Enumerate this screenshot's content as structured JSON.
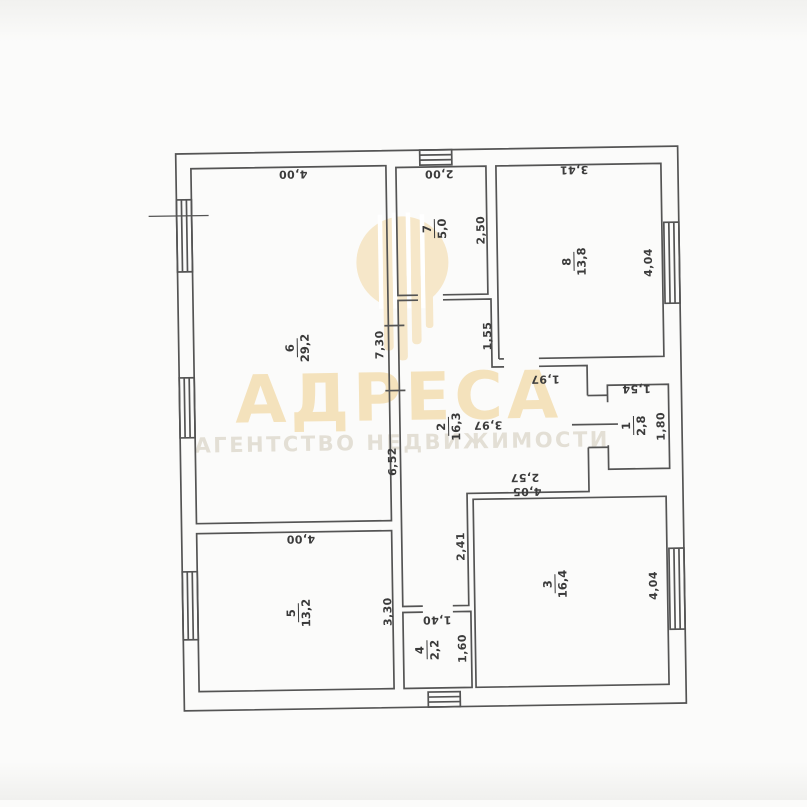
{
  "watermark": {
    "brand": "АДРЕСА",
    "tagline": "АГЕНТСТВО НЕДВИЖИМОСТИ",
    "brand_color": "#f4e2bc",
    "logo_color": "#f6e7c9",
    "tagline_color": "#e3dfd5"
  },
  "plan": {
    "line_color": "#545454",
    "rooms": [
      {
        "number": "6",
        "area": "29,2"
      },
      {
        "number": "7",
        "area": "5,0"
      },
      {
        "number": "8",
        "area": "13,8"
      },
      {
        "number": "2",
        "area": "16,3"
      },
      {
        "number": "1",
        "area": "2,8"
      },
      {
        "number": "3",
        "area": "16,4"
      },
      {
        "number": "5",
        "area": "13,2"
      },
      {
        "number": "4",
        "area": "2,2"
      }
    ],
    "dimensions": [
      {
        "value": "4,00"
      },
      {
        "value": "2,00"
      },
      {
        "value": "3,41"
      },
      {
        "value": "2,50"
      },
      {
        "value": "7,30"
      },
      {
        "value": "1,55"
      },
      {
        "value": "4,04"
      },
      {
        "value": "1,97"
      },
      {
        "value": "3,97"
      },
      {
        "value": "6,52"
      },
      {
        "value": "1,54"
      },
      {
        "value": "1,80"
      },
      {
        "value": "2,57"
      },
      {
        "value": "4,05"
      },
      {
        "value": "2,41"
      },
      {
        "value": "4,04"
      },
      {
        "value": "4,00"
      },
      {
        "value": "3,30"
      },
      {
        "value": "1,40"
      },
      {
        "value": "1,60"
      }
    ]
  }
}
